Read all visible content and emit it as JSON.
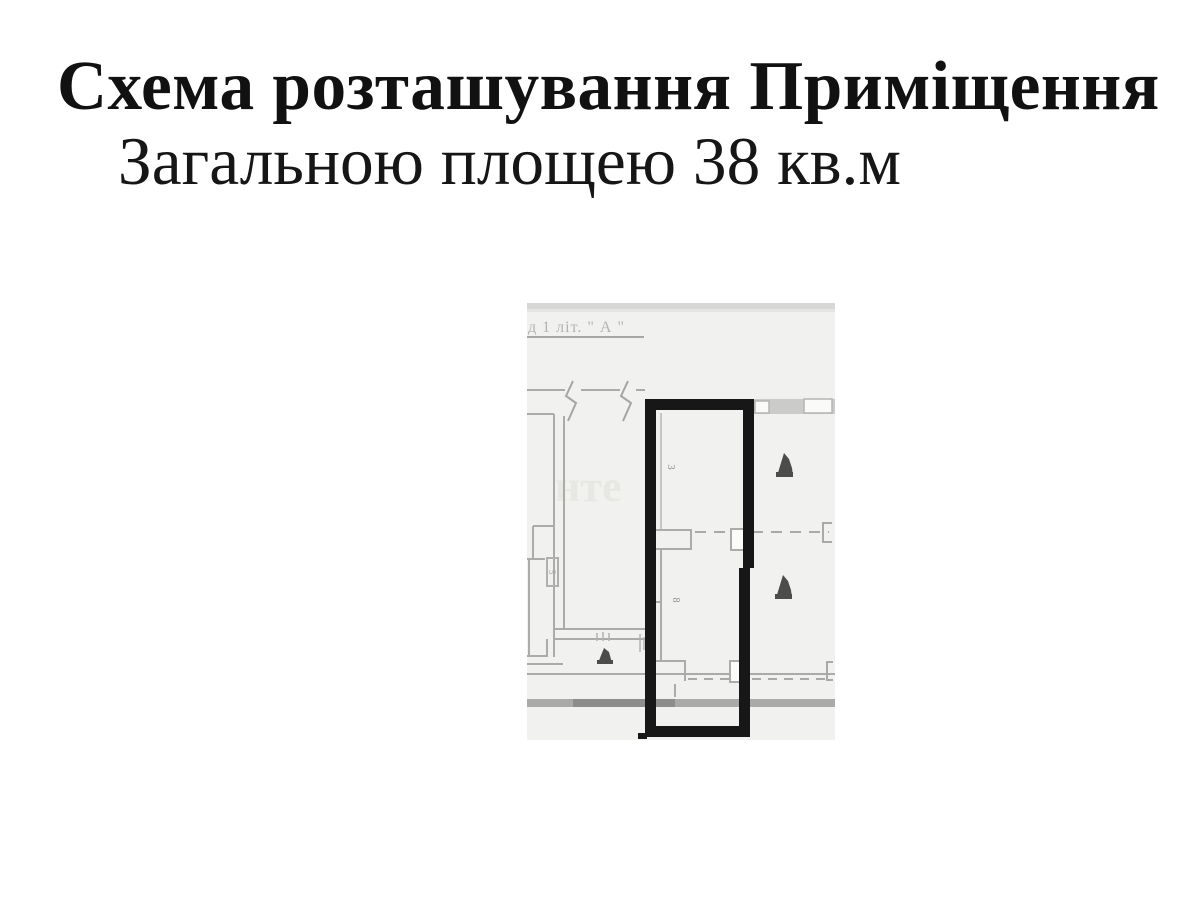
{
  "title": {
    "line1": "Схема розташування Приміщення",
    "line2": "Загальною площею 38 кв.м"
  },
  "floor_plan": {
    "caption": "д 1 літ. \" А \"",
    "watermark": "нте",
    "room_labels": {
      "upper": "3",
      "lower": "8",
      "closet": "5"
    },
    "colors": {
      "plan_background": "#f1f1ef",
      "plan_lines": "#ababa9",
      "unit_outline": "#171717",
      "scan_band": "#d7d7d5",
      "wall_band": "#cbcbc9",
      "dark_bar": "#8d8d8b",
      "door_glyph": "#4c4c4a"
    }
  }
}
